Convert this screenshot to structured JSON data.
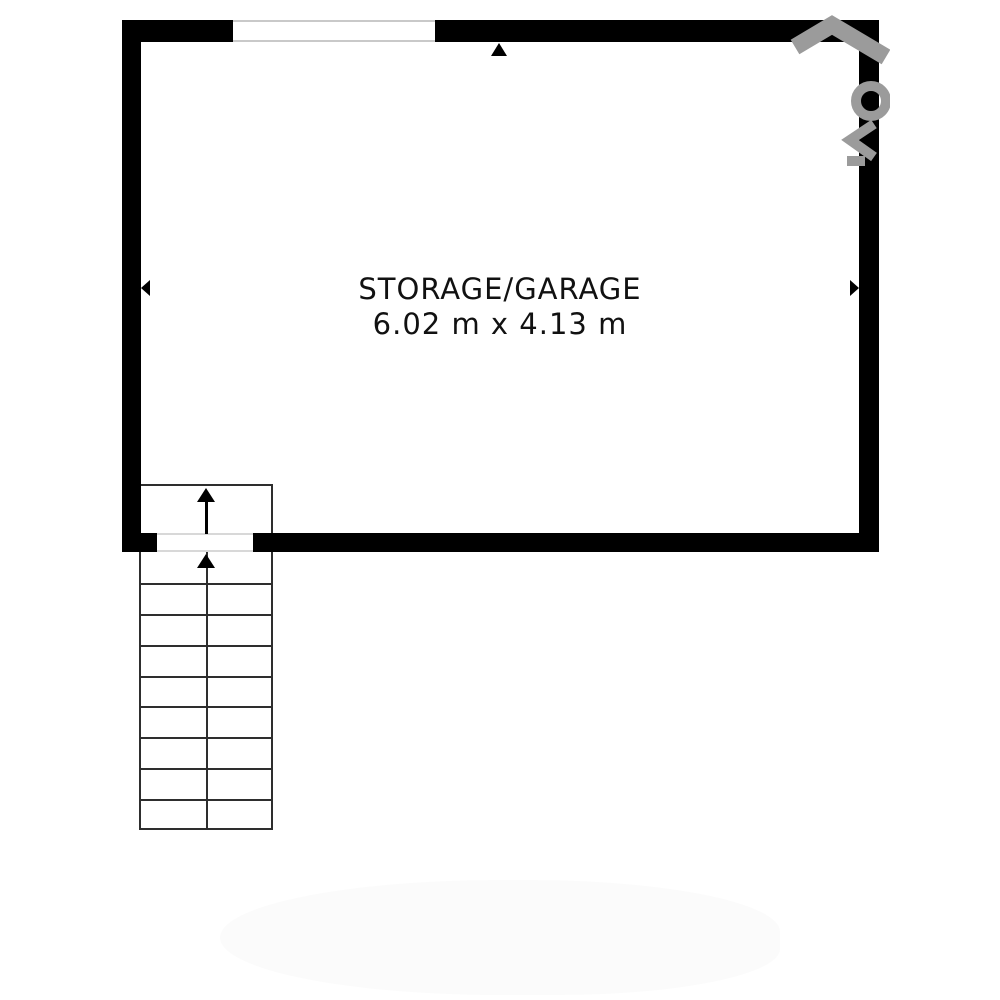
{
  "room": {
    "label": "STORAGE/GARAGE",
    "dimensions": "6.02 m x 4.13 m"
  },
  "stairs": {
    "rows_below_wall": 9,
    "columns": 2,
    "direction": "up"
  },
  "markers": {
    "top_wall_arrow": "up",
    "left_wall_arrow": "left",
    "right_wall_arrow": "right",
    "stair_upper_arrow": "up",
    "stair_lower_arrow": "up"
  },
  "openings": {
    "top_wall_window": true,
    "bottom_wall_stair_opening": true
  },
  "watermark": {
    "present": true,
    "shapes": [
      "roof-chevron",
      "ring",
      "angle-mark",
      "bar"
    ]
  },
  "colors": {
    "wall": "#000000",
    "background": "#ffffff",
    "stair_line": "#2e2e2e",
    "window_line": "#c9c9c9",
    "watermark": "#9b9b9b",
    "text": "#111111",
    "door_line": "#d8d8d8"
  }
}
